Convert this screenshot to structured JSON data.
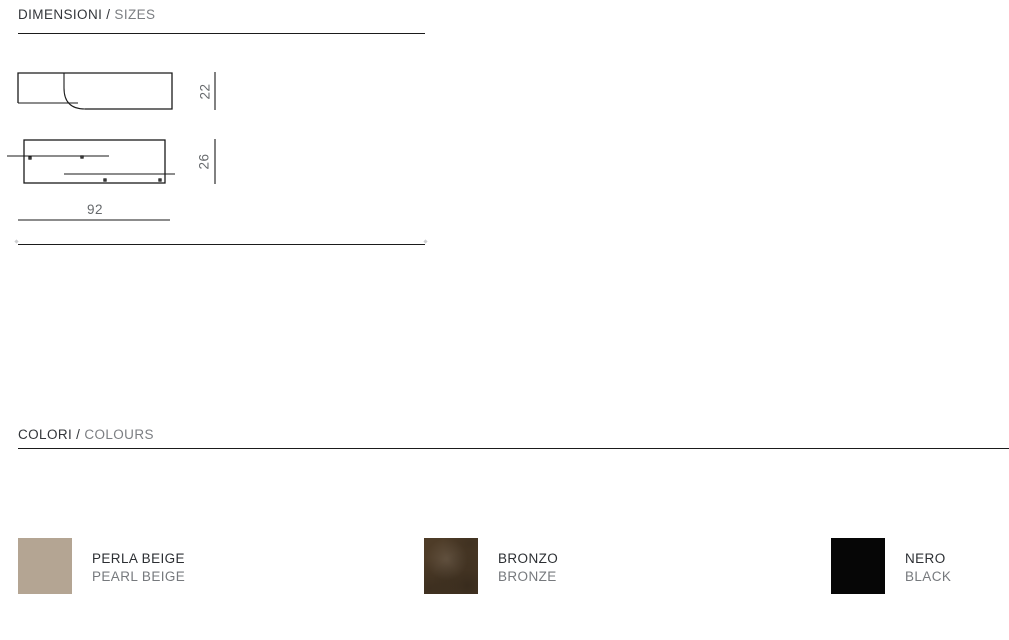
{
  "dimensions_section": {
    "title_it": "DIMENSIONI",
    "divider": "/",
    "title_en": "SIZES",
    "profile_height_label": "22",
    "front_height_label": "26",
    "width_label": "92"
  },
  "colors_section": {
    "title_it": "COLORI",
    "divider": "/",
    "title_en": "COLOURS",
    "swatches": [
      {
        "name_it": "PERLA BEIGE",
        "name_en": "PEARL BEIGE",
        "hex": "#b4a593"
      },
      {
        "name_it": "BRONZO",
        "name_en": "BRONZE",
        "hex": "#4e3c28"
      },
      {
        "name_it": "NERO",
        "name_en": "BLACK",
        "hex": "#060606"
      }
    ]
  },
  "theme": {
    "text_dark": "#33363a",
    "text_gray": "#7b7e82",
    "line_color": "#1a1a1a",
    "background": "#ffffff"
  }
}
